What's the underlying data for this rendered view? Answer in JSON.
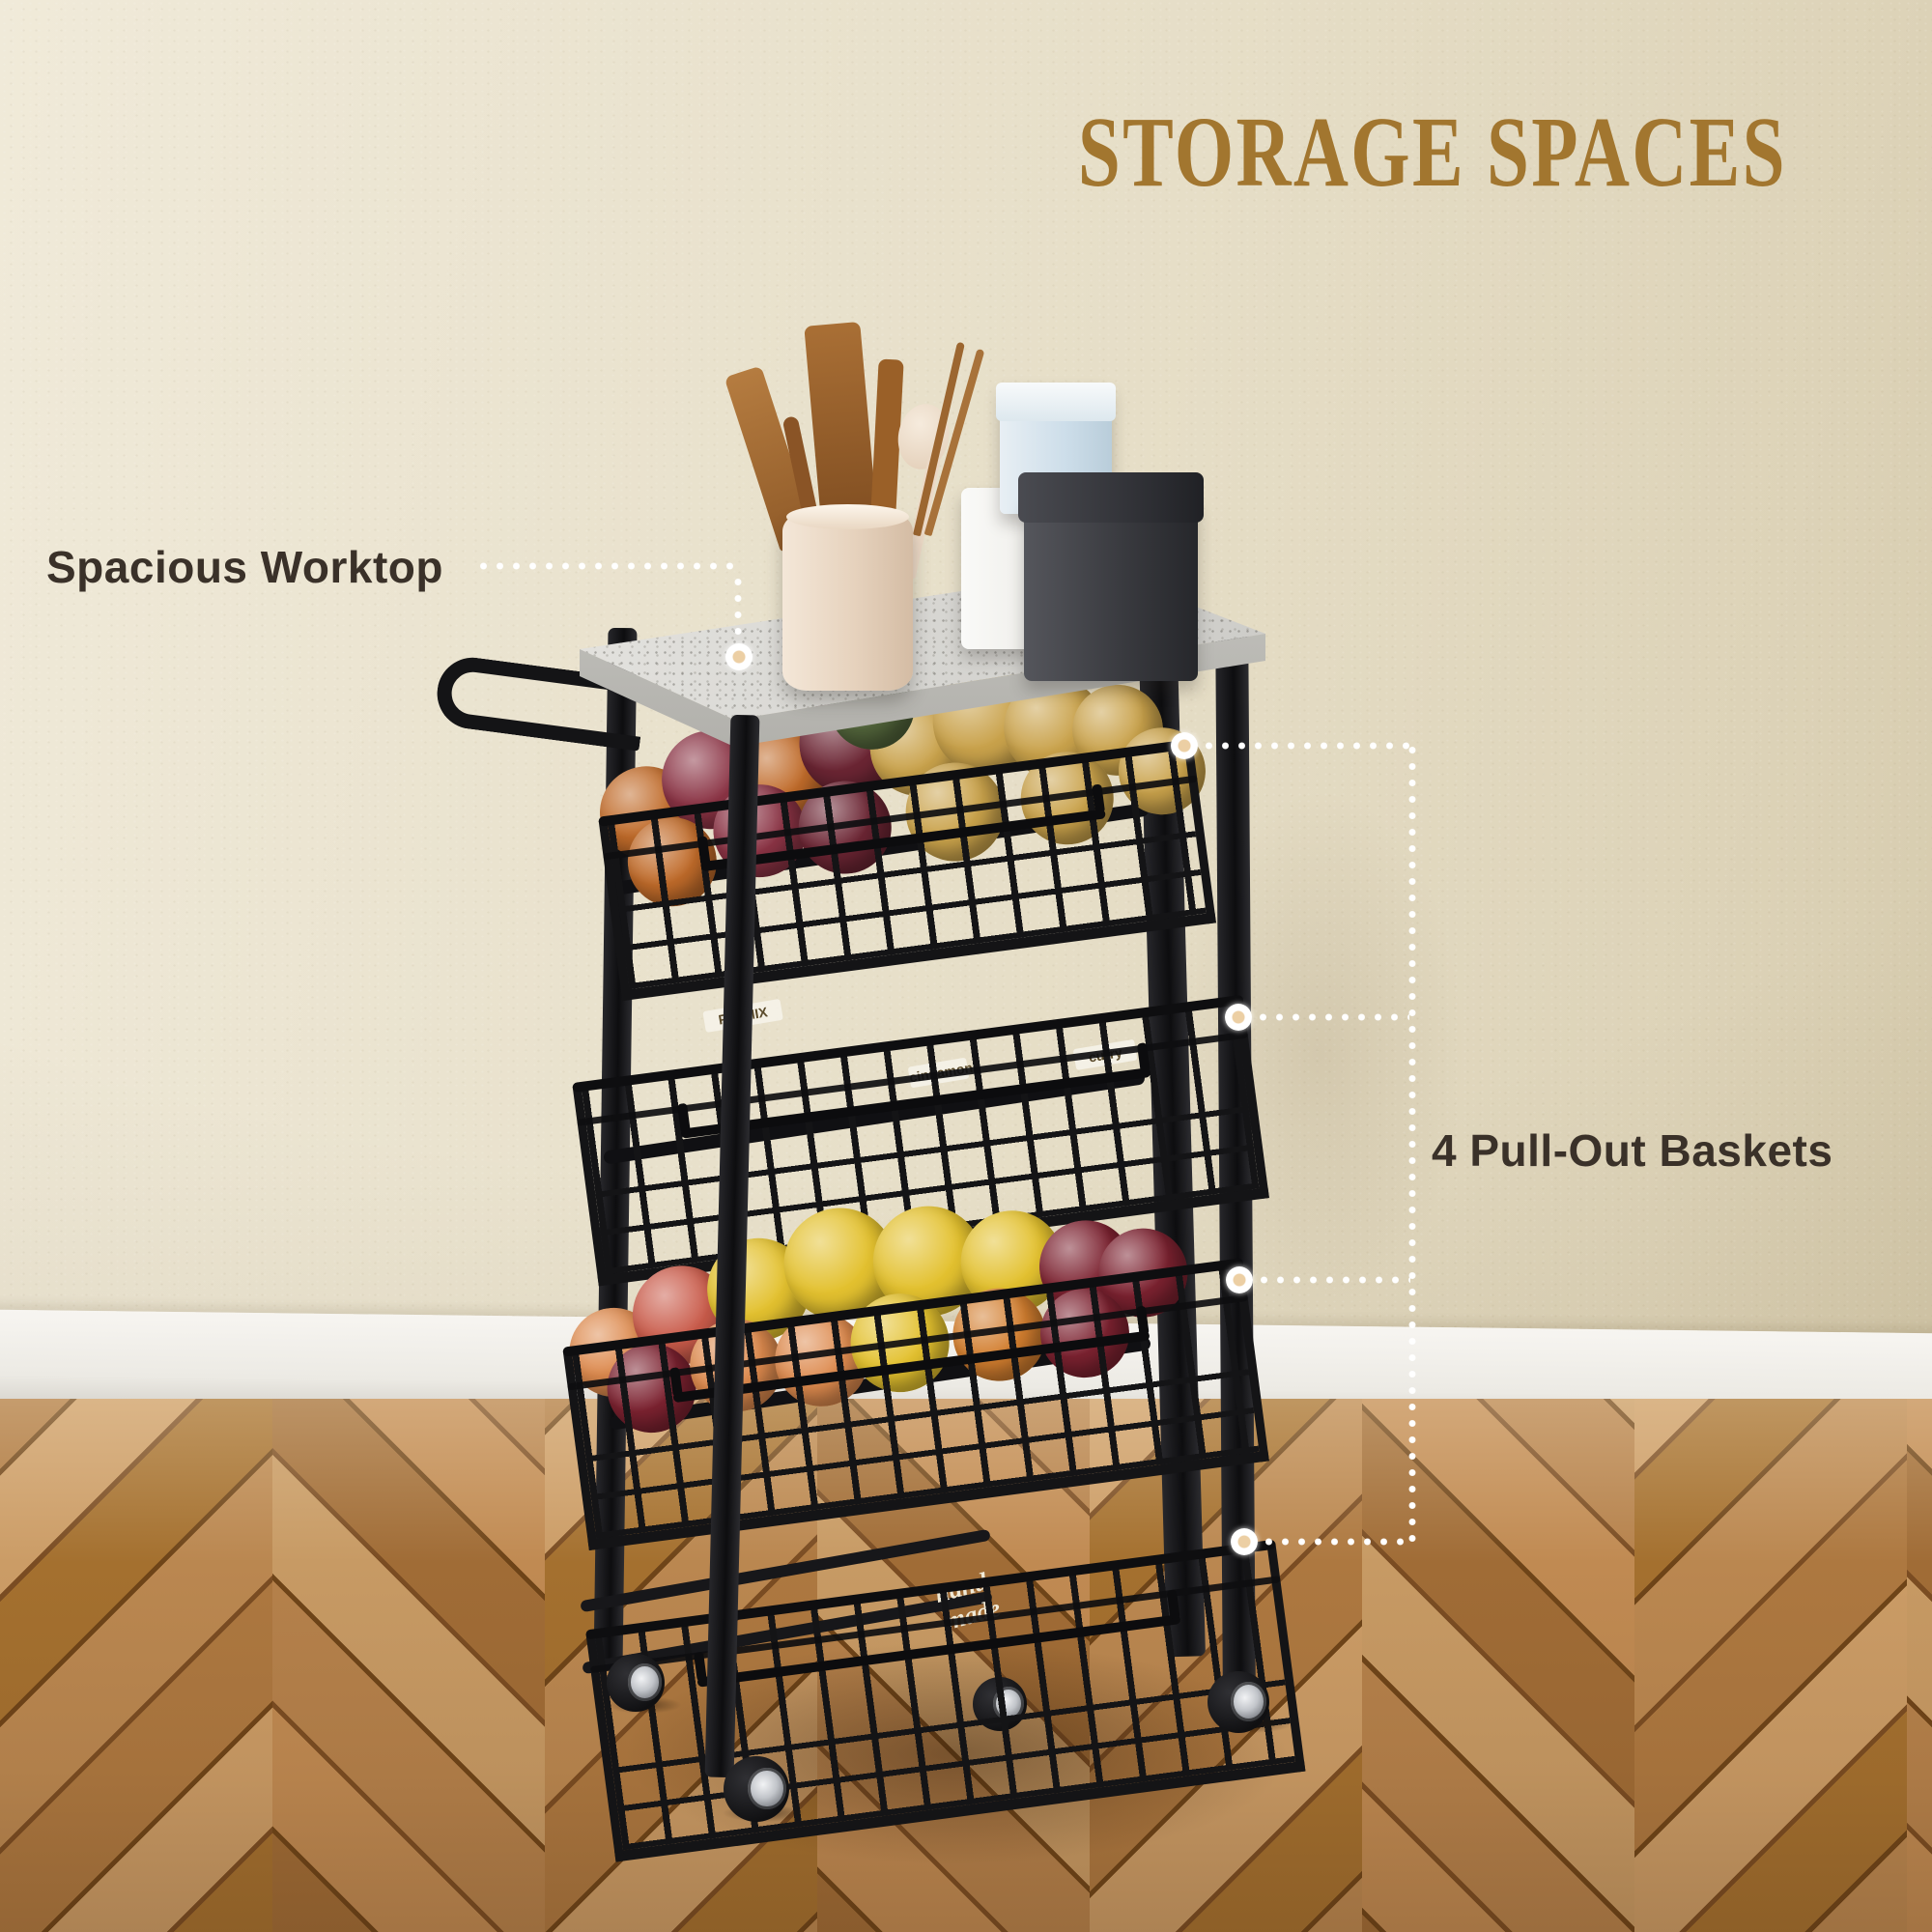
{
  "title": "STORAGE SPACES",
  "callout_left": {
    "label": "Spacious Worktop"
  },
  "callout_right": {
    "label": "4 Pull-Out Baskets"
  },
  "colors": {
    "title_gold": "#a2762f",
    "label_brown": "#3a3129",
    "dot_white": "#ffffff",
    "wall_beige": "#e7dfc8",
    "baseboard_white": "#f4f2ee",
    "frame_black": "#141416",
    "marble_gray": "#d6d5d1",
    "floor_oak": "#b5814b"
  },
  "cart": {
    "baskets": [
      {
        "id": "fruit-vegetable-basket",
        "contents": "red onions, orange onions, potatoes, squash",
        "style": "round",
        "palette": [
          "#8a3344",
          "#c06b2a",
          "#c9a24b",
          "#51633a",
          "#6b2533"
        ],
        "labels": []
      },
      {
        "id": "spice-jar-basket",
        "contents": "spice jars and boxes",
        "style": "jar",
        "palette": [
          "#d9d4c8",
          "#7d8c3f",
          "#c08030",
          "#a33f2e",
          "#efece6",
          "#cf7a28"
        ],
        "labels": [
          "PIE MIX",
          "cinnamon",
          "curry"
        ]
      },
      {
        "id": "fruit-basket",
        "contents": "bananas, lemons, peaches, cherries, grapes",
        "style": "round",
        "palette": [
          "#e3c12f",
          "#dd8a4e",
          "#c95b4a",
          "#7c2230",
          "#d27e2f"
        ],
        "labels": []
      },
      {
        "id": "pantry-jar-basket",
        "contents": "flour canisters, hand-made jar, spice bottles",
        "style": "jar",
        "palette": [
          "#e9e6df",
          "#2a2a2c",
          "#b68938",
          "#4c5d46"
        ],
        "labels": [
          "hand-made"
        ]
      }
    ]
  }
}
